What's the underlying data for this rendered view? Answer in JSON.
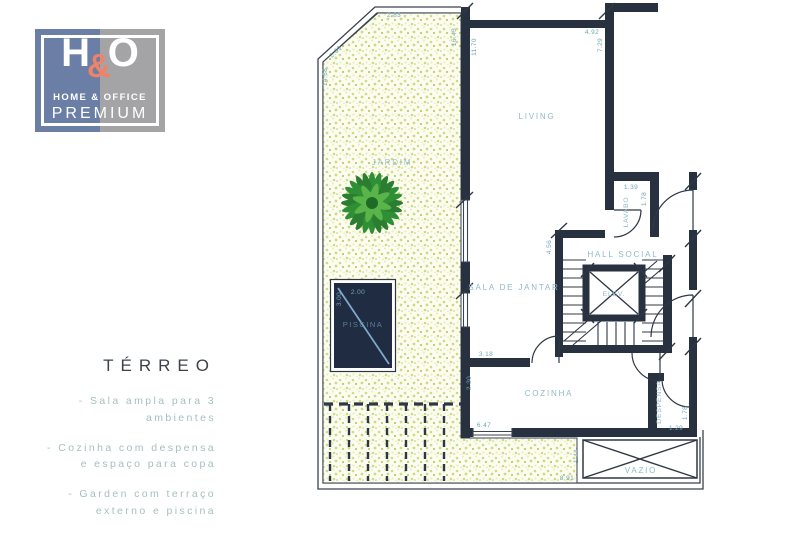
{
  "logo": {
    "letter_h": "H",
    "ampersand": "&",
    "letter_o": "O",
    "subtitle": "HOME & OFFICE",
    "tagline": "PREMIUM"
  },
  "info_panel": {
    "title": "TÉRREO",
    "features": [
      "- Sala ampla para 3 ambientes",
      "- Cozinha com despensa e espaço para copa",
      "- Garden com terraço externo e piscina"
    ]
  },
  "floor_plan": {
    "rooms": {
      "jardim": "JARDIM",
      "living": "LIVING",
      "lavabo": "LAVABO",
      "hall_social": "HALL SOCIAL",
      "elevator": "ELEV.",
      "sala_de_jantar": "SALA DE JANTAR",
      "cozinha": "COZINHA",
      "despensa": "DESPENSA",
      "vazio": "VAZIO",
      "piscina": "PISCINA"
    },
    "dimensions": {
      "garden_top": "2.83",
      "garden_chamfer": "2.89",
      "garden_left": "14.68",
      "garden_right": "16.43",
      "living_left": "11.70",
      "living_top": "4.92",
      "living_right": "7.29",
      "lavabo_width": "1.39",
      "lavabo_depth": "1.78",
      "sala_wall": "4.56",
      "sala_opening": "3.18",
      "cozinha_left": "2.30",
      "cozinha_bottom": "6.47",
      "despensa_depth": "1.78",
      "despensa_width": "1.29",
      "pool_width": "2.00",
      "pool_length": "3.00",
      "terrace_depth": "1.44",
      "terrace_width": "8.91"
    },
    "colors": {
      "wall": "#273140",
      "line": "#39424f",
      "room_label": "#8fbac9",
      "dimension": "#6fa7b8",
      "speckle": "#ccdb84",
      "pool_fill": "#202c42",
      "pool_line": "#7fa9cc",
      "tree_green": "#2e8f35"
    }
  }
}
